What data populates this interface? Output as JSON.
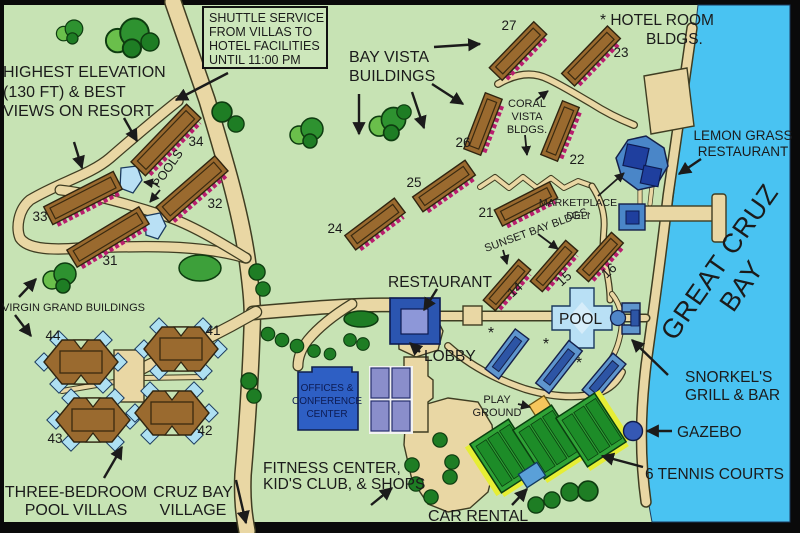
{
  "title": "Resort map",
  "labels": {
    "shuttle": [
      "SHUTTLE SERVICE",
      "FROM VILLAS TO",
      "HOTEL FACILITIES",
      "UNTIL 11:00 PM"
    ],
    "elevation": [
      "HIGHEST ELEVATION",
      "(130 FT) & BEST",
      "VIEWS ON RESORT"
    ],
    "bay_vista": [
      "BAY VISTA",
      "BUILDINGS"
    ],
    "hotel_room": [
      "* HOTEL ROOM",
      "BLDGS."
    ],
    "coral_vista": [
      "CORAL",
      "VISTA",
      "BLDGS."
    ],
    "lemon_grass": [
      "LEMON GRASS",
      "RESTAURANT"
    ],
    "marketplace": [
      "MARKETPLACE",
      "DELI"
    ],
    "sunset_bay": "SUNSET BAY BLDGS.",
    "great_cruz": [
      "GREAT CRUZ",
      "BAY"
    ],
    "restaurant": "RESTAURANT",
    "lobby": "LOBBY",
    "pool": "POOL",
    "pools": "POOLS",
    "snorkels": [
      "SNORKEL'S",
      "GRILL & BAR"
    ],
    "virgin_grand": "VIRGIN GRAND BUILDINGS",
    "offices": [
      "OFFICES &",
      "CONFERENCE",
      "CENTER"
    ],
    "playground": [
      "PLAY",
      "GROUND"
    ],
    "gazebo": "GAZEBO",
    "tennis": "6 TENNIS COURTS",
    "villas": [
      "THREE-BEDROOM",
      "POOL VILLAS"
    ],
    "cruz_bay": [
      "CRUZ BAY",
      "VILLAGE"
    ],
    "fitness": [
      "FITNESS CENTER,",
      "KID'S CLUB, & SHOPS"
    ],
    "car_rental": "CAR RENTAL",
    "asterisk": "*"
  },
  "numbers": {
    "n14": "14",
    "n15": "15",
    "n16": "16",
    "n21": "21",
    "n22": "22",
    "n23": "23",
    "n24": "24",
    "n25": "25",
    "n26": "26",
    "n27": "27",
    "n31": "31",
    "n32": "32",
    "n33": "33",
    "n34": "34",
    "n41": "41",
    "n42": "42",
    "n43": "43",
    "n44": "44"
  },
  "colors": {
    "land": "#c7e3b4",
    "water": "#49c3f2",
    "path": "#e9d7a4",
    "building_brown": "#9a6a2f",
    "balcony_pink": "#b81e6e",
    "hotel_blue": "#5e95cd",
    "hotel_blue_dark": "#2d55a5",
    "royal_blue": "#2b55b0",
    "lavender": "#8d97d8",
    "pool_blue": "#b9e0f5",
    "tennis_green": "#2fa336",
    "tennis_yellow": "#e6ee35",
    "tree_dark": "#1e7d24",
    "playground_orange": "#f6c65c",
    "ink": "#1b1b1b"
  }
}
